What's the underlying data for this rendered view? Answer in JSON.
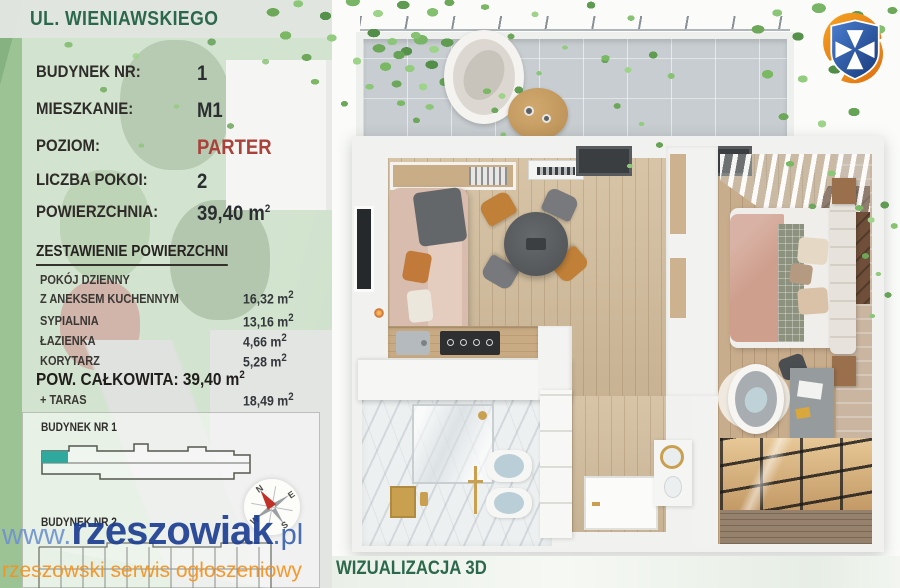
{
  "street_bar": {
    "title": "UL. WIENIAWSKIEGO"
  },
  "specs": {
    "rows": [
      {
        "label": "BUDYNEK NR:",
        "value": "1"
      },
      {
        "label": "MIESZKANIE:",
        "value": "M1"
      },
      {
        "label": "POZIOM:",
        "value": "PARTER"
      },
      {
        "label": "LICZBA POKOI:",
        "value": "2"
      },
      {
        "label": "POWIERZCHNIA:",
        "value": "39,40 m",
        "sup": "2"
      }
    ]
  },
  "areas": {
    "heading": "ZESTAWIENIE POWIERZCHNI",
    "rows": [
      {
        "line1": "POKÓJ DZIENNY",
        "line2": "Z ANEKSEM KUCHENNYM",
        "value": "16,32 m",
        "sup": "2"
      },
      {
        "line1": "SYPIALNIA",
        "value": "13,16 m",
        "sup": "2"
      },
      {
        "line1": "ŁAZIENKA",
        "value": "4,66 m",
        "sup": "2"
      },
      {
        "line1": "KORYTARZ",
        "value": "5,28 m",
        "sup": "2"
      }
    ],
    "total": {
      "label": "POW. CAŁKOWITA: 39,40 m",
      "sup": "2"
    },
    "taras": {
      "label": "+ TARAS",
      "value": "18,49 m",
      "sup": "2"
    }
  },
  "site_plan": {
    "building1_label": "BUDYNEK NR 1",
    "building2_label": "BUDYNEK NR 2",
    "compass": {
      "n": "N",
      "e": "E",
      "s": "S",
      "w": "W"
    }
  },
  "watermark": {
    "prefix": "www.",
    "name": "rzeszowiak",
    "suffix": ".pl",
    "tagline": "rzeszowski serwis ogłoszeniowy"
  },
  "viz": {
    "caption": "WIZUALIZACJA 3D"
  },
  "icons": {
    "logo": "city-crest-logo",
    "compass": "compass-rose-icon"
  },
  "colors": {
    "heading_green": "#2c684c",
    "accent_red": "#a8423a",
    "unit_highlight_teal": "#2fa89e",
    "watermark_blue": "#1d3f92",
    "watermark_light_blue": "#6f93cf",
    "tagline_orange": "#f6921e"
  }
}
